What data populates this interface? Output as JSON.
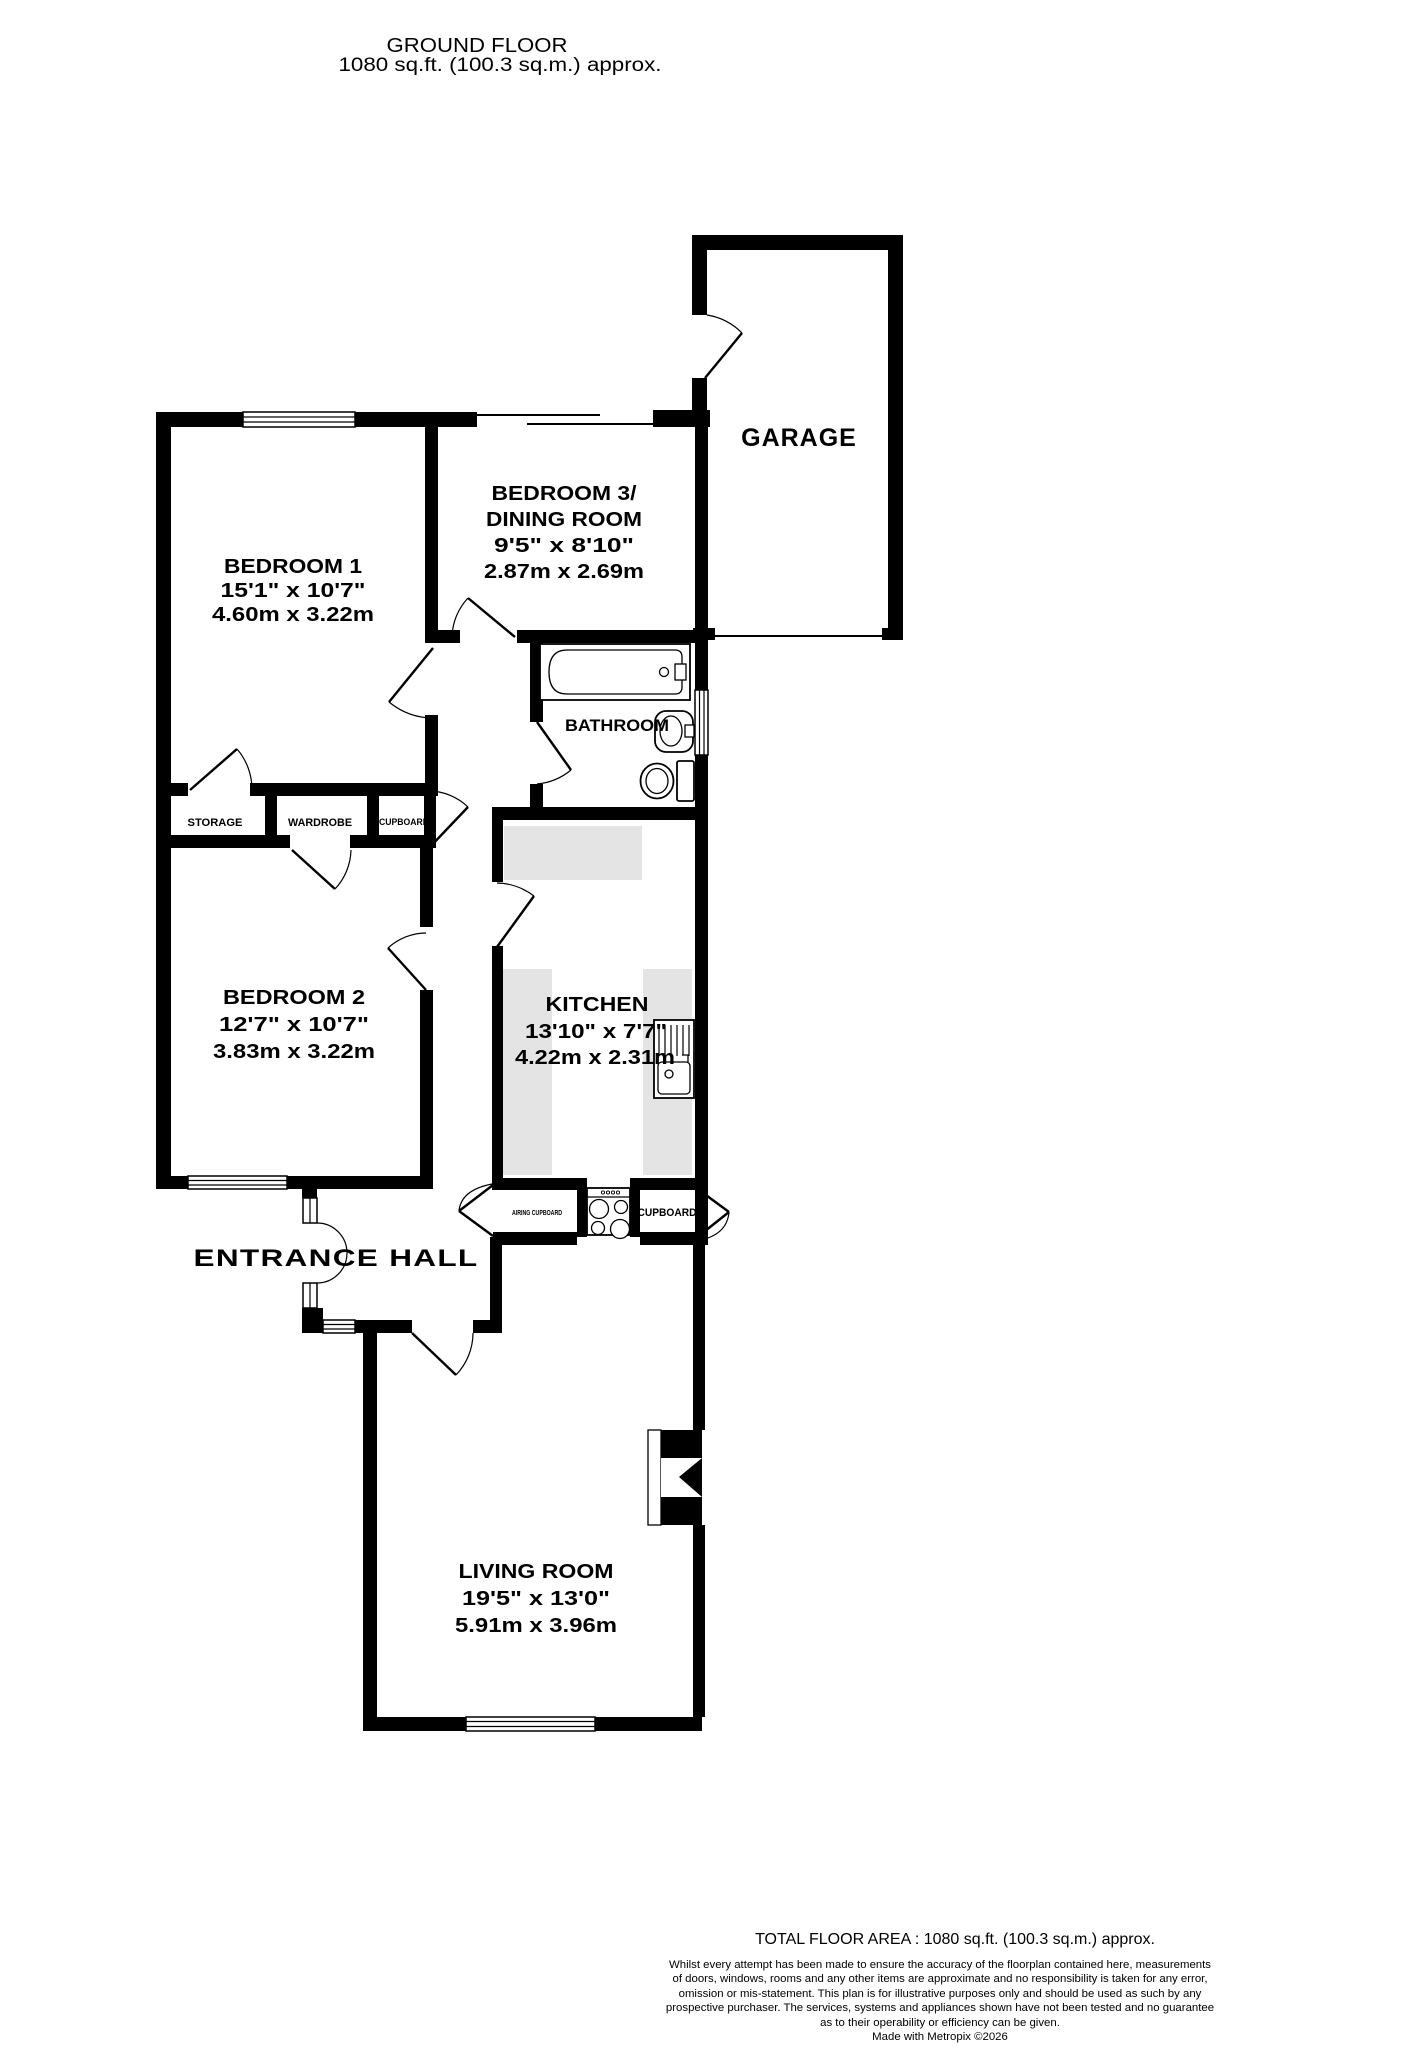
{
  "title": {
    "line1": "GROUND FLOOR",
    "line2": "1080 sq.ft. (100.3 sq.m.) approx."
  },
  "rooms": {
    "garage": {
      "name": "GARAGE"
    },
    "bedroom1": {
      "name": "BEDROOM 1",
      "size_imperial": "15'1\"  x 10'7\"",
      "size_metric": "4.60m  x 3.22m"
    },
    "bedroom3": {
      "name_line1": "BEDROOM 3/",
      "name_line2": "DINING ROOM",
      "size_imperial": "9'5\"  x 8'10\"",
      "size_metric": "2.87m  x 2.69m"
    },
    "bathroom": {
      "name": "BATHROOM"
    },
    "bedroom2": {
      "name": "BEDROOM 2",
      "size_imperial": "12'7\"  x 10'7\"",
      "size_metric": "3.83m  x 3.22m"
    },
    "kitchen": {
      "name": "KITCHEN",
      "size_imperial": "13'10\"  x 7'7\"",
      "size_metric": "4.22m  x 2.31m"
    },
    "living_room": {
      "name": "LIVING ROOM",
      "size_imperial": "19'5\"  x 13'0\"",
      "size_metric": "5.91m  x 3.96m"
    },
    "entrance_hall": {
      "name": "ENTRANCE HALL"
    },
    "storage": {
      "name": "STORAGE"
    },
    "wardrobe": {
      "name": "WARDROBE"
    },
    "cupboard_hall": {
      "name": "CUPBOARD"
    },
    "airing_cupboard": {
      "name": "AIRING CUPBOARD"
    },
    "cupboard_kitchen": {
      "name": "CUPBOARD"
    }
  },
  "footer": {
    "total_area": "TOTAL FLOOR AREA : 1080 sq.ft. (100.3 sq.m.) approx.",
    "disclaimer_lines": [
      "Whilst every attempt has been made to ensure the accuracy of the floorplan contained here, measurements",
      "of doors, windows, rooms and any other items are approximate and no responsibility is taken for any error,",
      "omission or mis-statement. This plan is for illustrative purposes only and should be used as such by any",
      "prospective purchaser. The services, systems and appliances shown have not been tested and no guarantee",
      "as to their operability or efficiency can be given."
    ],
    "credit": "Made with Metropix ©2026"
  },
  "colors": {
    "wall": "#000000",
    "counter": "#e4e4e4",
    "background": "#ffffff"
  }
}
